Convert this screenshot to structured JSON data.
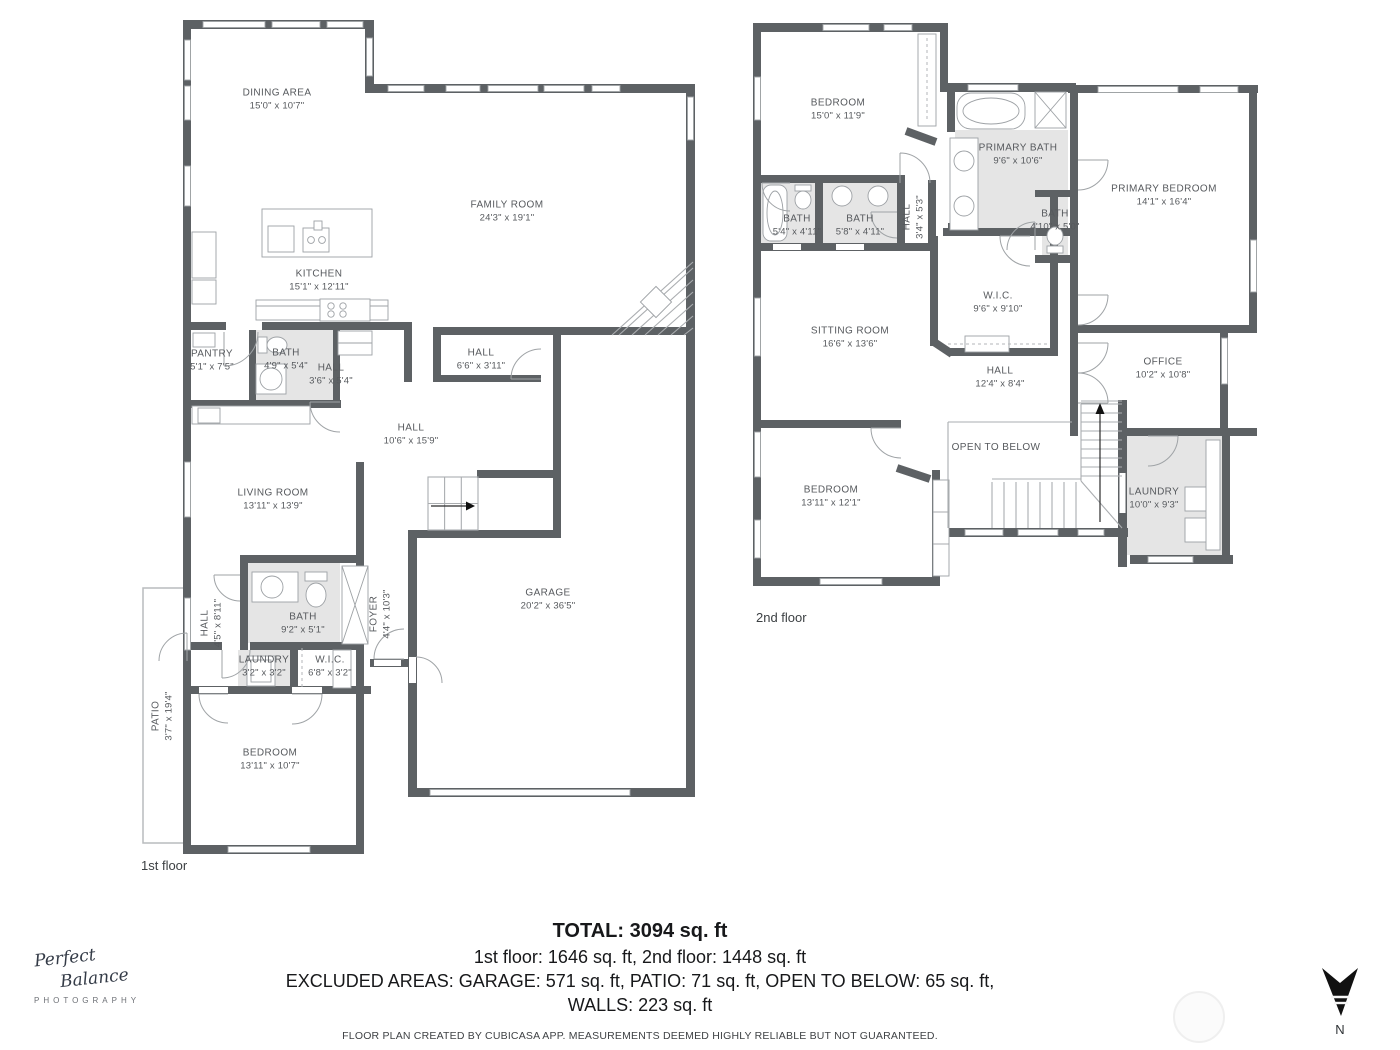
{
  "floor1": {
    "caption": "1st floor",
    "rooms": [
      {
        "name": "DINING AREA",
        "dims": "15'0\" x 10'7\""
      },
      {
        "name": "FAMILY ROOM",
        "dims": "24'3\" x 19'1\""
      },
      {
        "name": "KITCHEN",
        "dims": "15'1\" x 12'11\""
      },
      {
        "name": "PANTRY",
        "dims": "5'1\" x 7'5\""
      },
      {
        "name": "BATH",
        "dims": "4'9\" x 5'4\""
      },
      {
        "name": "HALL",
        "dims": "3'6\" x 5'4\""
      },
      {
        "name": "HALL",
        "dims": "6'6\" x 3'11\""
      },
      {
        "name": "HALL",
        "dims": "10'6\" x 15'9\""
      },
      {
        "name": "LIVING ROOM",
        "dims": "13'11\" x 13'9\""
      },
      {
        "name": "FOYER",
        "dims": "4'4\" x 10'3\""
      },
      {
        "name": "BATH",
        "dims": "9'2\" x 5'1\""
      },
      {
        "name": "HALL",
        "dims": "4'5\" x 8'11\""
      },
      {
        "name": "LAUNDRY",
        "dims": "3'2\" x 3'2\""
      },
      {
        "name": "W.I.C.",
        "dims": "6'8\" x 3'2\""
      },
      {
        "name": "BEDROOM",
        "dims": "13'11\" x 10'7\""
      },
      {
        "name": "GARAGE",
        "dims": "20'2\" x 36'5\""
      },
      {
        "name": "PATIO",
        "dims": "3'7\" x 19'4\""
      }
    ]
  },
  "floor2": {
    "caption": "2nd floor",
    "rooms": [
      {
        "name": "BEDROOM",
        "dims": "15'0\" x 11'9\""
      },
      {
        "name": "PRIMARY BATH",
        "dims": "9'6\" x 10'6\""
      },
      {
        "name": "PRIMARY BEDROOM",
        "dims": "14'1\" x 16'4\""
      },
      {
        "name": "BATH",
        "dims": "5'4\" x 4'11\""
      },
      {
        "name": "BATH",
        "dims": "5'8\" x 4'11\""
      },
      {
        "name": "HALL",
        "dims": "3'4\" x 5'3\""
      },
      {
        "name": "BATH",
        "dims": "4'10\" x 5'0\""
      },
      {
        "name": "W.I.C.",
        "dims": "9'6\" x 9'10\""
      },
      {
        "name": "SITTING ROOM",
        "dims": "16'6\" x 13'6\""
      },
      {
        "name": "HALL",
        "dims": "12'4\" x 8'4\""
      },
      {
        "name": "OFFICE",
        "dims": "10'2\" x 10'8\""
      },
      {
        "name": "OPEN TO BELOW",
        "dims": ""
      },
      {
        "name": "BEDROOM",
        "dims": "13'11\" x 12'1\""
      },
      {
        "name": "LAUNDRY",
        "dims": "10'0\" x 9'3\""
      }
    ]
  },
  "summary": {
    "total": "TOTAL: 3094 sq. ft",
    "floors": "1st floor: 1646 sq. ft, 2nd floor: 1448 sq. ft",
    "excluded": "EXCLUDED AREAS: GARAGE: 571 sq. ft, PATIO: 71 sq. ft, OPEN TO BELOW: 65 sq. ft,",
    "walls": "WALLS: 223 sq. ft",
    "disclaimer": "FLOOR PLAN CREATED BY CUBICASA APP. MEASUREMENTS DEEMED HIGHLY RELIABLE BUT NOT GUARANTEED."
  },
  "logo": {
    "line1": "Perfect",
    "line2": "Balance",
    "line3": "PHOTOGRAPHY"
  },
  "compass": {
    "label": "N"
  },
  "colors": {
    "wall": "#5d6164",
    "room_fill": "#e5e5e5",
    "text": "#56595d"
  }
}
